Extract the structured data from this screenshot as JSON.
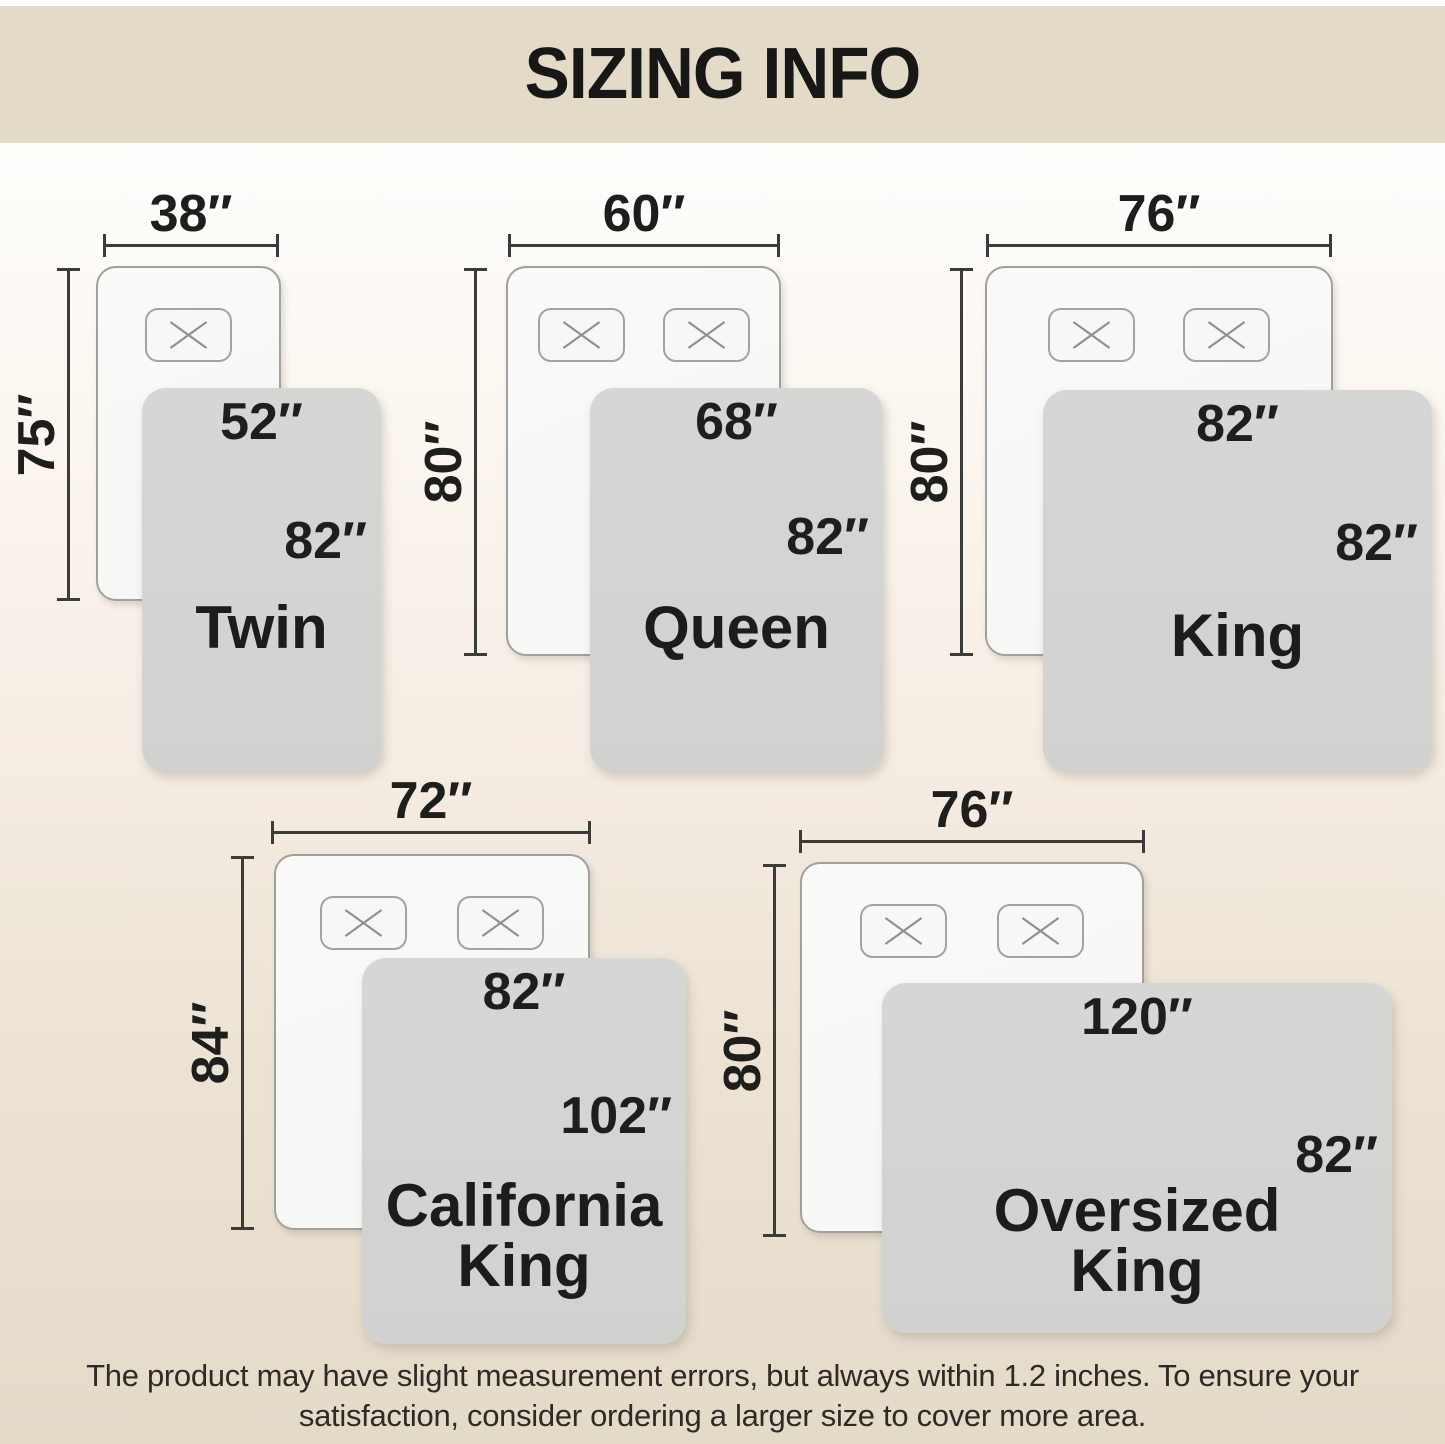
{
  "title": "SIZING INFO",
  "footer": {
    "line1": "The product may have slight measurement errors, but always within 1.2 inches. To ensure your",
    "line2": "satisfaction, consider ordering a larger size to cover more area."
  },
  "colors": {
    "banner_bg": "#e3dac7",
    "page_gradient_top": "#fefefc",
    "page_gradient_bottom": "#e4dac8",
    "blanket_gray": "#d3d3d2",
    "mattress_white": "#f8f8f6",
    "dimension_line": "#3b3b39",
    "text": "#1e1e1c"
  },
  "sizes": [
    {
      "name": "Twin",
      "name_line2": "",
      "mattress_width": "38″",
      "mattress_length": "75″",
      "blanket_width": "52″",
      "blanket_length": "82″",
      "pillow_count": 1
    },
    {
      "name": "Queen",
      "name_line2": "",
      "mattress_width": "60″",
      "mattress_length": "80″",
      "blanket_width": "68″",
      "blanket_length": "82″",
      "pillow_count": 2
    },
    {
      "name": "King",
      "name_line2": "",
      "mattress_width": "76″",
      "mattress_length": "80″",
      "blanket_width": "82″",
      "blanket_length": "82″",
      "pillow_count": 2
    },
    {
      "name": "California",
      "name_line2": "King",
      "mattress_width": "72″",
      "mattress_length": "84″",
      "blanket_width": "82″",
      "blanket_length": "102″",
      "pillow_count": 2
    },
    {
      "name": "Oversized",
      "name_line2": "King",
      "mattress_width": "76″",
      "mattress_length": "80″",
      "blanket_width": "120″",
      "blanket_length": "82″",
      "pillow_count": 2
    }
  ]
}
